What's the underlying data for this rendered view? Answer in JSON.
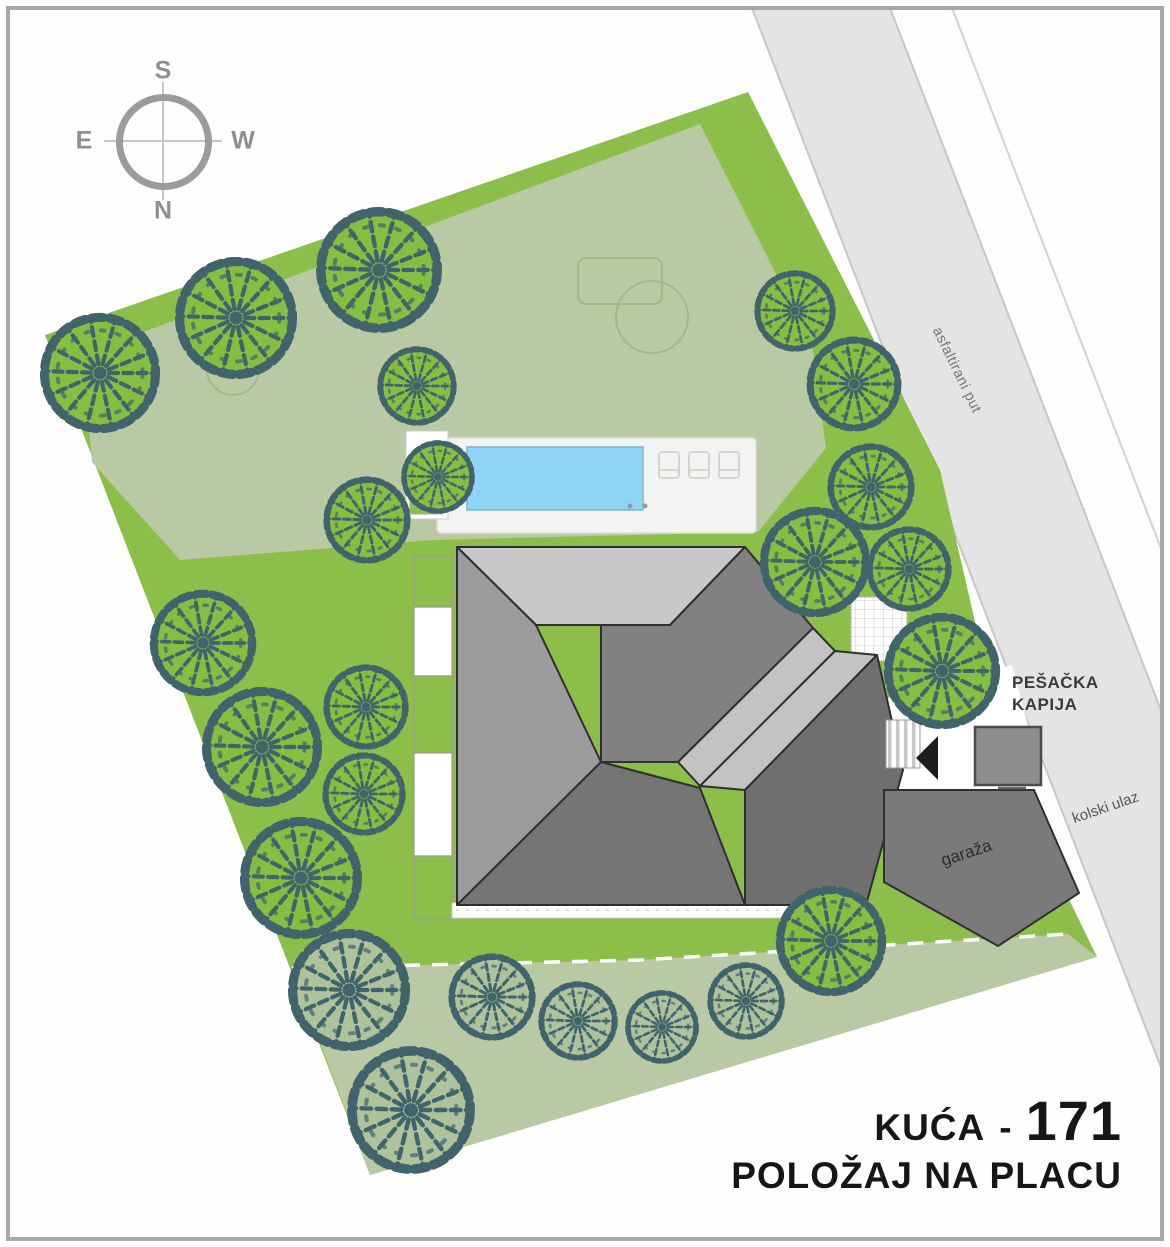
{
  "title": {
    "house": "KUĆA",
    "separator": "-",
    "number": "171",
    "subtitle": "POLOŽAJ NA PLACU"
  },
  "compass": {
    "top": "S",
    "bottom": "N",
    "left": "E",
    "right": "W"
  },
  "labels": {
    "road": "asfaltirani put",
    "pedestrian_gate": [
      "PEŠAČKA",
      "KAPIJA"
    ],
    "vehicle_entrance": "kolski ulaz",
    "garage": "garaža"
  },
  "colors": {
    "lawn": "#8cbe4a",
    "sage": "#b9c9a4",
    "sage_outline": "#a3b78d",
    "tree_line": "#41646c",
    "tree_bright": "#84bf41",
    "tree_sage": "#aec29b",
    "road": "#e4e4e4",
    "road_edge": "#c6c6c6",
    "pool": "#8ed4f4",
    "pool_edge": "#7fb4cc",
    "deck": "#f3f3f1",
    "deck_edge": "#dddddb",
    "roof_light": "#c8c8c8",
    "roof_mid": "#9c9c9c",
    "roof_dark": "#757575",
    "roof_band_dark": "#818181",
    "roof_band_light": "#c3c3c3",
    "roof_se": "#6f6f6f",
    "outline": "#2f2f2f",
    "garage": "#7a7a7a",
    "gate": "#8f8f8f",
    "walk_edge": "#9a9a9a",
    "text_dark": "#161616",
    "label_gray": "#3a3a3a",
    "compass": "#9b9b9b",
    "frame": "#a8a8a8"
  },
  "site": {
    "trees": [
      {
        "x": 100,
        "y": 373,
        "r": 62,
        "v": "bright"
      },
      {
        "x": 236,
        "y": 318,
        "r": 63,
        "v": "bright"
      },
      {
        "x": 379,
        "y": 270,
        "r": 65,
        "v": "bright"
      },
      {
        "x": 417,
        "y": 386,
        "r": 41,
        "v": "bright"
      },
      {
        "x": 367,
        "y": 520,
        "r": 45,
        "v": "bright"
      },
      {
        "x": 438,
        "y": 477,
        "r": 38,
        "v": "bright"
      },
      {
        "x": 203,
        "y": 643,
        "r": 55,
        "v": "bright"
      },
      {
        "x": 262,
        "y": 747,
        "r": 62,
        "v": "bright"
      },
      {
        "x": 366,
        "y": 707,
        "r": 44,
        "v": "bright"
      },
      {
        "x": 364,
        "y": 794,
        "r": 43,
        "v": "bright"
      },
      {
        "x": 301,
        "y": 878,
        "r": 63,
        "v": "bright"
      },
      {
        "x": 795,
        "y": 311,
        "r": 42,
        "v": "bright"
      },
      {
        "x": 854,
        "y": 384,
        "r": 49,
        "v": "bright"
      },
      {
        "x": 871,
        "y": 487,
        "r": 45,
        "v": "bright"
      },
      {
        "x": 815,
        "y": 562,
        "r": 57,
        "v": "bright"
      },
      {
        "x": 909,
        "y": 569,
        "r": 44,
        "v": "bright"
      },
      {
        "x": 942,
        "y": 671,
        "r": 60,
        "v": "bright"
      },
      {
        "x": 831,
        "y": 941,
        "r": 57,
        "v": "bright"
      },
      {
        "x": 349,
        "y": 990,
        "r": 63,
        "v": "sage"
      },
      {
        "x": 411,
        "y": 1110,
        "r": 66,
        "v": "sage"
      },
      {
        "x": 492,
        "y": 997,
        "r": 45,
        "v": "sage"
      },
      {
        "x": 578,
        "y": 1021,
        "r": 41,
        "v": "sage"
      },
      {
        "x": 662,
        "y": 1027,
        "r": 38,
        "v": "sage"
      },
      {
        "x": 746,
        "y": 1001,
        "r": 40,
        "v": "sage"
      }
    ]
  }
}
